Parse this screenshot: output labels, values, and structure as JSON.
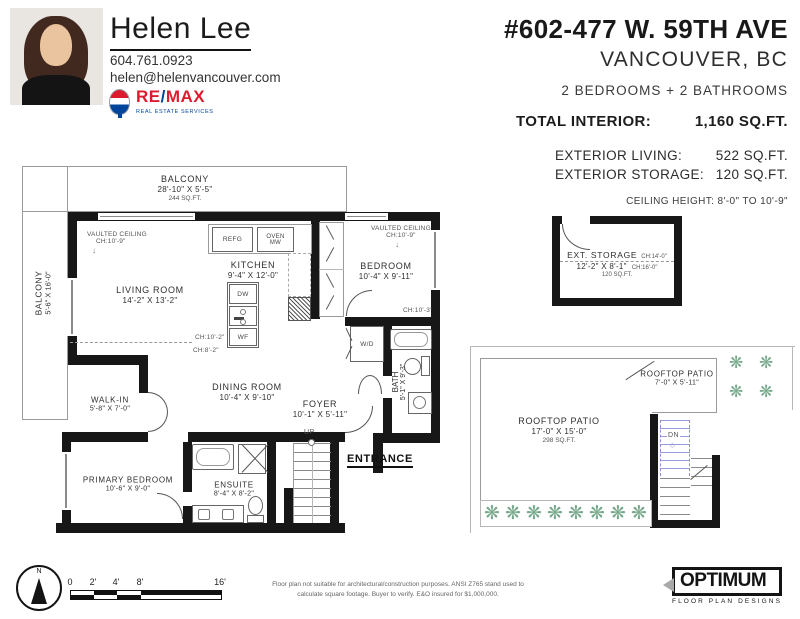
{
  "agent": {
    "name": "Helen Lee",
    "phone": "604.761.0923",
    "email": "helen@helenvancouver.com",
    "brand_re": "RE",
    "brand_slash": "/",
    "brand_max": "MAX",
    "brand_sub": "REAL ESTATE SERVICES"
  },
  "listing": {
    "address": "#602-477 W. 59TH AVE",
    "city": "VANCOUVER, BC",
    "beds_baths": "2 BEDROOMS + 2 BATHROOMS",
    "total_interior_label": "TOTAL INTERIOR:",
    "total_interior_value": "1,160 SQ.FT.",
    "exterior_living_label": "EXTERIOR LIVING:",
    "exterior_living_value": "522 SQ.FT.",
    "exterior_storage_label": "EXTERIOR STORAGE:",
    "exterior_storage_value": "120 SQ.FT.",
    "ceiling_height": "CEILING HEIGHT: 8'-0\" TO 10'-9\""
  },
  "rooms": {
    "balcony_top": {
      "name": "BALCONY",
      "dims": "28'-10\" X 5'-5\"",
      "area": "244 SQ.FT."
    },
    "balcony_left": {
      "name": "BALCONY",
      "dims": "5'-6\" X 16'-0\""
    },
    "living": {
      "name": "LIVING ROOM",
      "dims": "14'-2\" X 13'-2\""
    },
    "kitchen": {
      "name": "KITCHEN",
      "dims": "9'-4\" X 12'-0\""
    },
    "bedroom": {
      "name": "BEDROOM",
      "dims": "10'-4\" X 9'-11\""
    },
    "dining": {
      "name": "DINING ROOM",
      "dims": "10'-4\" X 9'-10\""
    },
    "foyer": {
      "name": "FOYER",
      "dims": "10'-1\" X 5'-11\""
    },
    "bath": {
      "name": "BATH",
      "dims": "5'-1\" X 9'-3\""
    },
    "walkin": {
      "name": "WALK-IN",
      "dims": "5'-8\" X 7'-0\""
    },
    "primary": {
      "name": "PRIMARY BEDROOM",
      "dims": "10'-6\" X 9'-0\""
    },
    "ensuite": {
      "name": "ENSUITE",
      "dims": "8'-4\" X 8'-2\""
    },
    "storage": {
      "name": "EXT. STORAGE",
      "dims": "12'-2\" X 8'-1\"",
      "area": "120 SQ.FT.",
      "ch1": "CH:14'-0\"",
      "ch2": "CH:16'-0\""
    },
    "patio_small": {
      "name": "ROOFTOP PATIO",
      "dims": "7'-0\" X 5'-11\""
    },
    "patio_large": {
      "name": "ROOFTOP PATIO",
      "dims": "17'-0\" X 15'-0\"",
      "area": "298 SQ.FT."
    }
  },
  "notes": {
    "vaulted_1_l1": "VAULTED CEILING",
    "vaulted_1_l2": "CH:10'-9\"",
    "vaulted_2_l1": "VAULTED CEILING",
    "vaulted_2_l2": "CH:10'-9\"",
    "ch_102": "CH:10'-2\"",
    "ch_82": "CH:8'-2\"",
    "ch_103": "CH:10'-3\"",
    "entrance": "ENTRANCE",
    "up": "UP",
    "dn": "DN"
  },
  "fixtures": {
    "refg": "REFG",
    "oven": "OVEN",
    "mw": "MW",
    "dw": "DW",
    "wf": "WF",
    "wd": "W/D"
  },
  "icons": {
    "plant_glyph": "❋",
    "down_arrow": "↓",
    "dn_diamond": "◇"
  },
  "scale": {
    "t0": "0",
    "t1": "2'",
    "t2": "4'",
    "t3": "8'",
    "t4": "16'"
  },
  "compass": {
    "n": "N"
  },
  "footer": {
    "disclaimer1": "Floor plan not suitable for architectural/construction purposes. ANSI Z765 stand used to",
    "disclaimer2": "calculate square footage. Buyer to verify.  E&O insured for $1,000,000.",
    "logo_title": "OPTIMUM",
    "logo_sub": "FLOOR PLAN DESIGNS"
  }
}
